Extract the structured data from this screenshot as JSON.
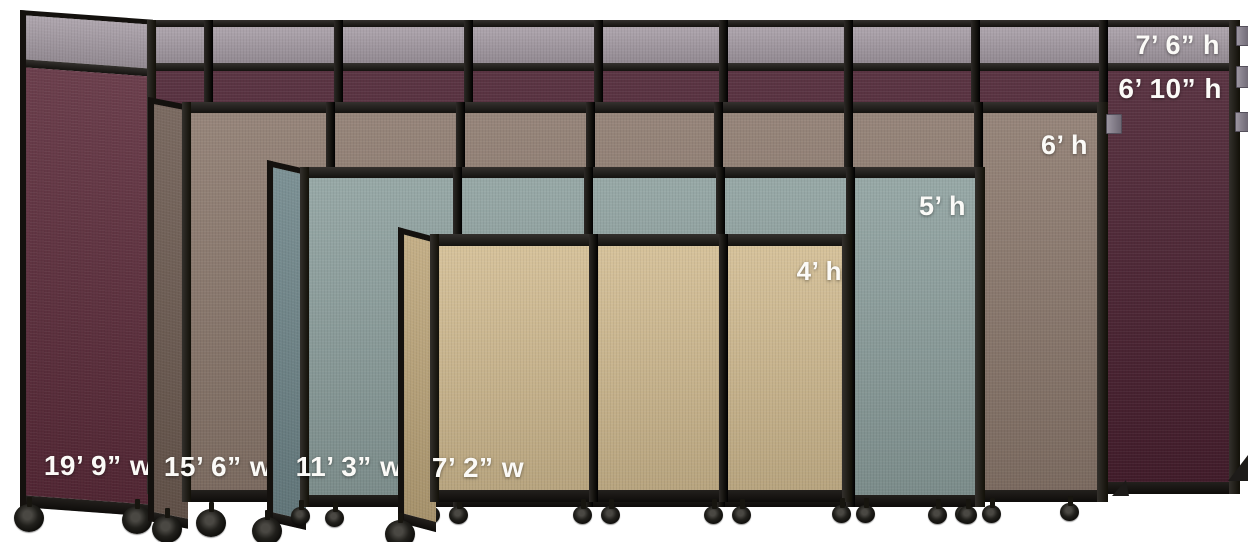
{
  "scene": {
    "description": "Portable room divider partitions shown in five sizes for comparison",
    "background_color": "#ffffff",
    "frame_color": "#1d1b19",
    "label_text_color": "#fbfaf7"
  },
  "partitions": [
    {
      "id": "partition-burgundy-tallest",
      "top_strip_color": "#a79da6",
      "fabric_color": "#4a2030",
      "end_panel_color": "#5c2b3a",
      "top_height_label": "7’ 6” h",
      "height_label": "6’ 10” h",
      "width_label": "19’ 9” w"
    },
    {
      "id": "partition-mocha",
      "fabric_color": "#8c796d",
      "end_panel_color": "#6d5b51",
      "height_label": "6’ h",
      "width_label": "15’ 6” w"
    },
    {
      "id": "partition-slate-blue",
      "fabric_color": "#8da09e",
      "end_panel_color": "#6f868a",
      "height_label": "5’ h",
      "width_label": "11’ 3” w"
    },
    {
      "id": "partition-sand-beige",
      "fabric_color": "#d2bc91",
      "end_panel_color": "#bea77b",
      "height_label": "4’ h",
      "width_label": "7’ 2” w"
    }
  ]
}
